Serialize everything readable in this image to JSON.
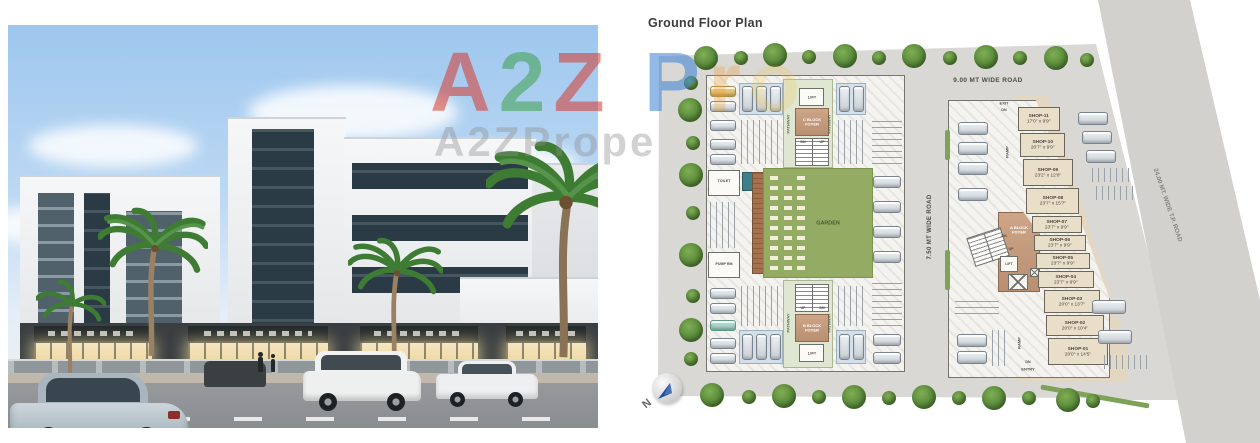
{
  "colors": {
    "plan_site_gray": "#d9d8d4",
    "garden_green": "#93ab62",
    "foyer_tan": "#c29a7f",
    "shop_beige": "#e9dfc9",
    "deck_brown": "#9a6a4e",
    "tree_green": "#5d8f3e",
    "watermark_red": "#d63a2f",
    "watermark_blue": "#3b82d4",
    "sky_blue": "#9ec7ee",
    "north_arrow_blue": "#1f4e9c"
  },
  "watermark": {
    "l1a": "A",
    "l1b": "2",
    "l1c": "Z",
    "l1d": "P",
    "l1e": "r",
    "l1f": "o",
    "line2": "A2ZPrope"
  },
  "plan": {
    "title": "Ground Floor Plan",
    "road_top": "9.00 MT WIDE ROAD",
    "road_middle": "7.50 MT WIDE ROAD",
    "road_tp": "24.00 MT. WIDE T.P. ROAD",
    "garden": "GARDEN",
    "pathway": "PATHWAY",
    "lift": "LIFT",
    "up": "UP",
    "dn": "DN",
    "exit": "EXIT",
    "entry": "ENTRY",
    "ramp": "RAMP",
    "toilet": "TOILET",
    "pump_room": "PUMP RM",
    "foyer_a": "A BLOCK FOYER",
    "foyer_b": "B BLOCK FOYER",
    "foyer_c": "C BLOCK FOYER",
    "north": "N",
    "shops": [
      {
        "name": "SHOP-01",
        "size": "20'0\" x 14'5\""
      },
      {
        "name": "SHOP-02",
        "size": "20'0\" x 10'4\""
      },
      {
        "name": "SHOP-03",
        "size": "20'0\" x 13'7\""
      },
      {
        "name": "SHOP-04",
        "size": "23'7\" x 9'9\""
      },
      {
        "name": "SHOP-05",
        "size": "23'7\" x 9'9\""
      },
      {
        "name": "SHOP-06",
        "size": "23'7\" x 9'9\""
      },
      {
        "name": "SHOP-07",
        "size": "23'7\" x 9'9\""
      },
      {
        "name": "SHOP-08",
        "size": "23'7\" x 15'7\""
      },
      {
        "name": "SHOP-09",
        "size": "23'2\" x 12'0\""
      },
      {
        "name": "SHOP-10",
        "size": "20'7\" x 9'9\""
      },
      {
        "name": "SHOP-11",
        "size": "17'0\" x 9'9\""
      }
    ]
  }
}
